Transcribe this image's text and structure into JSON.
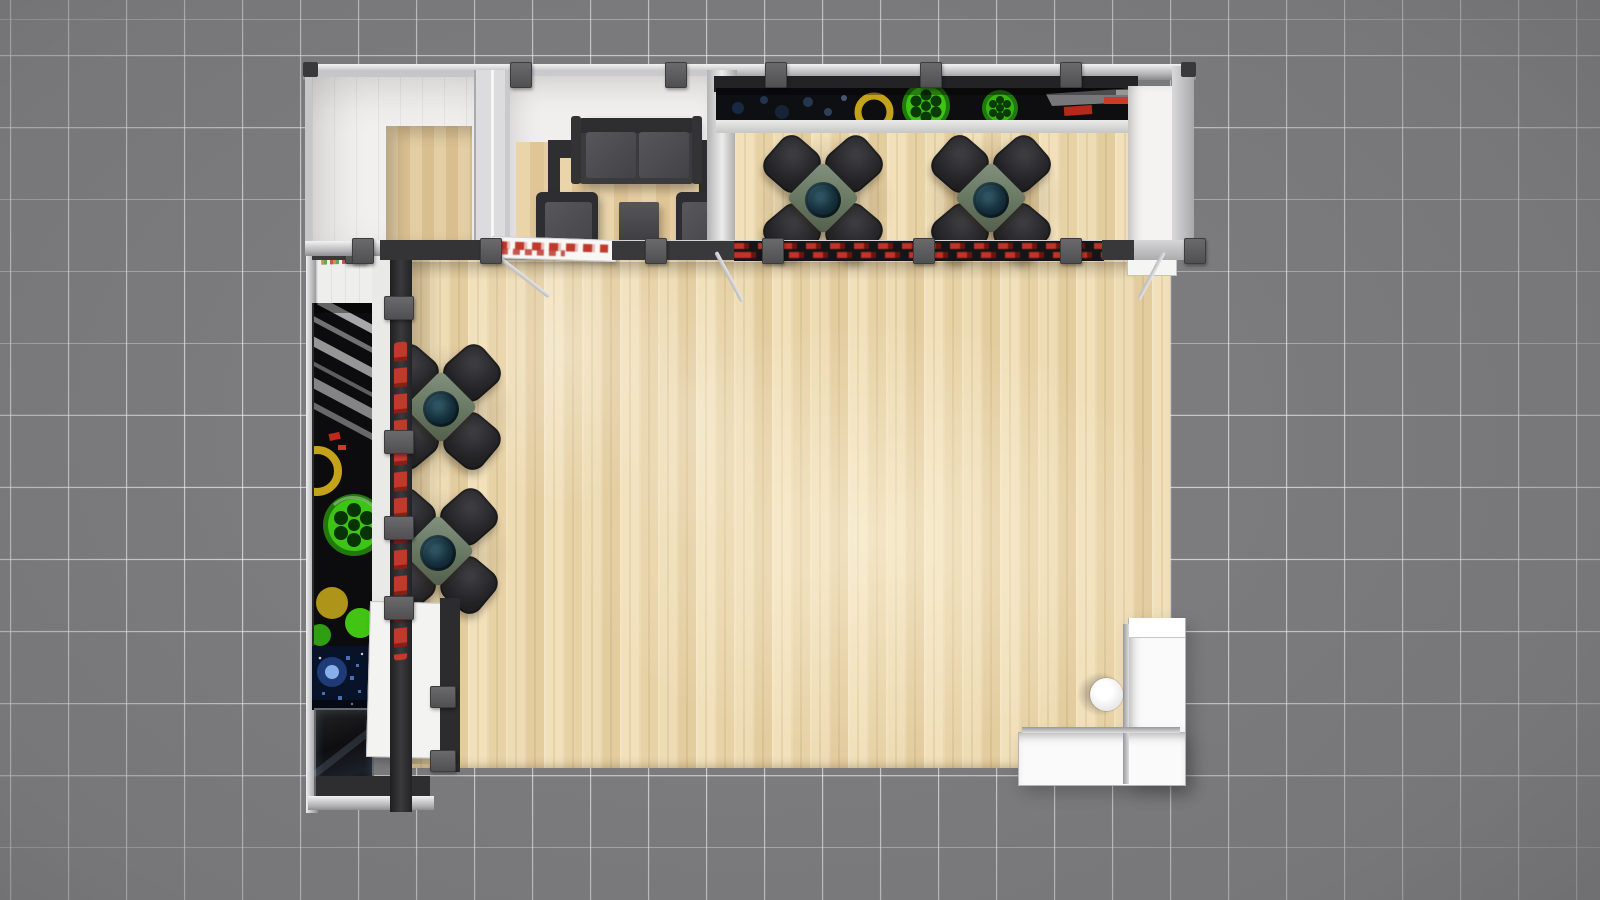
{
  "scene": {
    "title": "Trade show exhibit booth — top-down 3D render",
    "view": "plan view from directly above",
    "environment": "gray exhibit-hall floor with white tile grid lines"
  },
  "colors": {
    "hallFloor": "#7b7b7d",
    "gridLine": "#f2f2f2",
    "woodMid": "#ecd9b2",
    "wallWhite": "#f1f0ee",
    "frameSilver": "#c7c7c9",
    "trimDark": "#2f2f31",
    "clampGray": "#505052",
    "chairBlack": "#232326",
    "tableSage": "#66755f",
    "glassTeal": "#0d1d26",
    "sofaGray": "#3b3b3e",
    "accentRed": "#c0392b",
    "reelGreen": "#3ec414",
    "accentYellow": "#d8b31c",
    "counterWhite": "#fafafa",
    "graphicBlack": "#0e0e10",
    "digitalBlue": "#3a6fd8"
  },
  "booth": {
    "rooms": [
      {
        "name": "storage-room",
        "label": "Enclosed storage room with wood floor"
      },
      {
        "name": "lounge-room",
        "label": "Meeting lounge with sofa, two armchairs and coffee table"
      },
      {
        "name": "dining-area",
        "label": "Hospitality area with two bistro tables, four chairs each"
      },
      {
        "name": "open-floor",
        "label": "Open wood presentation floor with two bistro tables, four chairs each"
      },
      {
        "name": "reception",
        "label": "L-shaped white reception counter with one round stool"
      }
    ],
    "furniture_counts": {
      "sofas": 1,
      "armchairs": 2,
      "coffee_tables": 1,
      "bistro_tables": 4,
      "bistro_chairs": 16,
      "counters": 1,
      "stools": 1
    },
    "graphics": [
      {
        "name": "back-wall-graphic",
        "label": "Dark banner graphic with green film reels, blue bokeh lights, yellow ring and red accents"
      },
      {
        "name": "left-wall-graphic",
        "label": "Dark banner graphic with gray diagonal stripes, green film reel, yellow ring and blue digital pattern"
      },
      {
        "name": "red-lettering-sign",
        "label": "Vertical red channel lettering seen edge-on (illegible from above)"
      },
      {
        "name": "red-header-strip",
        "label": "Red and black printed header strip seen edge-on"
      },
      {
        "name": "white-header-banner",
        "label": "White header banner with red lettering seen edge-on (illegible from above)"
      }
    ]
  }
}
